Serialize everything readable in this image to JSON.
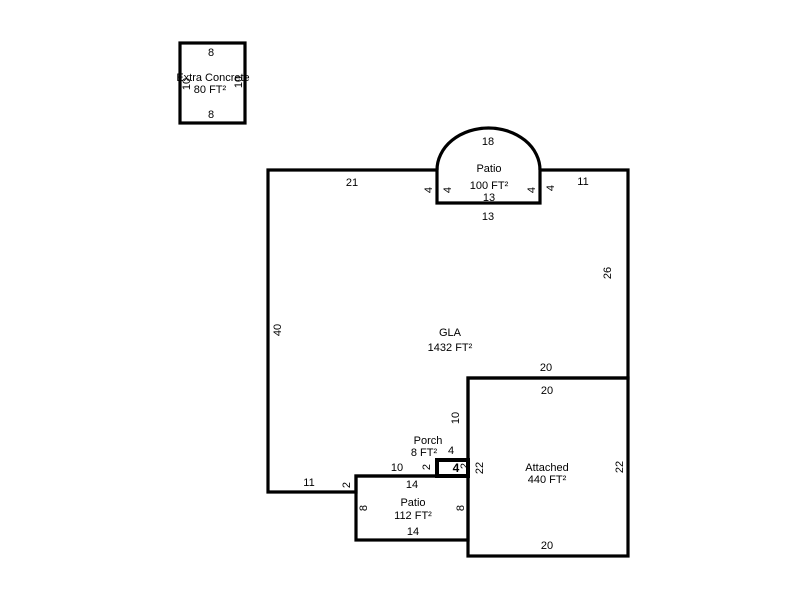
{
  "diagram": {
    "type": "floor-plan-sketch",
    "colors": {
      "line": "#000000",
      "text": "#000000",
      "background": "#ffffff"
    },
    "extra_concrete": {
      "name": "Extra Concrete",
      "area": "80 FT²",
      "dim_top": "8",
      "dim_bottom": "8",
      "dim_left": "10",
      "dim_right": "10"
    },
    "patio_top": {
      "name": "Patio",
      "area": "100 FT²",
      "dim_arc": "18",
      "dim_base_inner": "13",
      "dim_base_outer": "13",
      "dim_left_outer": "4",
      "dim_left_inner": "4",
      "dim_right_inner": "4",
      "dim_right_outer": "4"
    },
    "gla": {
      "name": "GLA",
      "area": "1432 FT²",
      "dim_top": "21",
      "dim_top_right": "11",
      "dim_right": "26",
      "dim_left": "40",
      "dim_bottom_left": "11",
      "dim_step": "2",
      "dim_bottom_mid": "10",
      "dim_porch_side": "2",
      "dim_porch_top": "4",
      "dim_inner_right": "10",
      "dim_attach_top": "20"
    },
    "porch": {
      "name": "Porch",
      "area": "8 FT²",
      "dim_width": "4",
      "dim_height": "2"
    },
    "patio_bottom": {
      "name": "Patio",
      "area": "112 FT²",
      "dim_top": "14",
      "dim_bottom": "14",
      "dim_left": "8",
      "dim_right": "8"
    },
    "attached": {
      "name": "Attached",
      "area": "440 FT²",
      "dim_top": "20",
      "dim_bottom": "20",
      "dim_left": "22",
      "dim_right": "22"
    }
  }
}
